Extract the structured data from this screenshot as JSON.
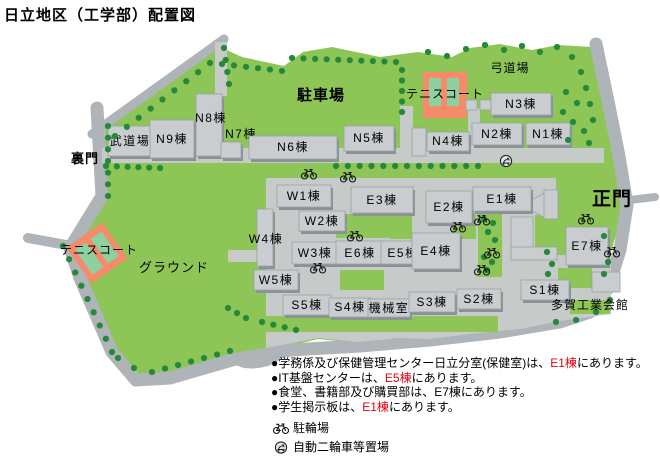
{
  "title": "日立地区（工学部）配置図",
  "map": {
    "area_labels": [
      {
        "id": "parking-lot",
        "label": "駐車場",
        "x": 321,
        "y": 100,
        "size": 15,
        "bold": true
      },
      {
        "id": "kyudo-hall",
        "label": "弓道場",
        "x": 510,
        "y": 72,
        "size": 12,
        "bold": false
      },
      {
        "id": "tennis-court-north",
        "label": "テニスコート",
        "x": 445,
        "y": 98,
        "size": 12,
        "bold": false
      },
      {
        "id": "tennis-court-west",
        "label": "テニスコート",
        "x": 99,
        "y": 254,
        "size": 12,
        "bold": false
      },
      {
        "id": "ground",
        "label": "グラウンド",
        "x": 174,
        "y": 272,
        "size": 13,
        "bold": false
      },
      {
        "id": "back-gate",
        "label": "裏門",
        "x": 85,
        "y": 163,
        "size": 13,
        "bold": true
      },
      {
        "id": "main-gate",
        "label": "正門",
        "x": 612,
        "y": 205,
        "size": 19,
        "bold": true
      },
      {
        "id": "taga-kogyo-hall",
        "label": "多賀工業会館",
        "x": 590,
        "y": 309,
        "size": 12,
        "bold": false
      }
    ],
    "buildings": [
      {
        "id": "budokan",
        "label": "武道場",
        "x": 108,
        "y": 126,
        "w": 44,
        "h": 30,
        "lx": 130,
        "ly": 145
      },
      {
        "id": "n9",
        "label": "N9棟",
        "x": 150,
        "y": 120,
        "w": 44,
        "h": 38,
        "lx": 172,
        "ly": 143
      },
      {
        "id": "n8",
        "label": "N8棟",
        "x": 196,
        "y": 94,
        "w": 26,
        "h": 62,
        "lx": 211,
        "ly": 122
      },
      {
        "id": "n7",
        "label": "N7棟",
        "x": 221,
        "y": 142,
        "w": 20,
        "h": 16,
        "lx": 241,
        "ly": 138
      },
      {
        "id": "n6",
        "label": "N6棟",
        "x": 249,
        "y": 136,
        "w": 88,
        "h": 23,
        "lx": 293,
        "ly": 151
      },
      {
        "id": "n5",
        "label": "N5棟",
        "x": 344,
        "y": 126,
        "w": 50,
        "h": 25,
        "lx": 369,
        "ly": 142
      },
      {
        "id": "n4",
        "label": "N4棟",
        "x": 427,
        "y": 132,
        "w": 42,
        "h": 19,
        "lx": 448,
        "ly": 145
      },
      {
        "id": "n3",
        "label": "N3棟",
        "x": 491,
        "y": 93,
        "w": 60,
        "h": 22,
        "lx": 521,
        "ly": 108
      },
      {
        "id": "n2",
        "label": "N2棟",
        "x": 472,
        "y": 123,
        "w": 50,
        "h": 22,
        "lx": 497,
        "ly": 138
      },
      {
        "id": "n1",
        "label": "N1棟",
        "x": 526,
        "y": 123,
        "w": 44,
        "h": 22,
        "lx": 548,
        "ly": 138
      },
      {
        "id": "w1",
        "label": "W1棟",
        "x": 277,
        "y": 185,
        "w": 54,
        "h": 22,
        "lx": 304,
        "ly": 200
      },
      {
        "id": "w2",
        "label": "W2棟",
        "x": 299,
        "y": 211,
        "w": 46,
        "h": 20,
        "lx": 322,
        "ly": 225
      },
      {
        "id": "w4",
        "label": "W4棟",
        "x": 257,
        "y": 209,
        "w": 16,
        "h": 57,
        "lx": 266,
        "ly": 243
      },
      {
        "id": "w3",
        "label": "W3棟",
        "x": 292,
        "y": 242,
        "w": 46,
        "h": 22,
        "lx": 315,
        "ly": 257
      },
      {
        "id": "w5",
        "label": "W5棟",
        "x": 254,
        "y": 270,
        "w": 44,
        "h": 20,
        "lx": 276,
        "ly": 284
      },
      {
        "id": "e3",
        "label": "E3棟",
        "x": 351,
        "y": 187,
        "w": 62,
        "h": 26,
        "lx": 382,
        "ly": 204
      },
      {
        "id": "e2",
        "label": "E2棟",
        "x": 426,
        "y": 191,
        "w": 46,
        "h": 32,
        "lx": 449,
        "ly": 211
      },
      {
        "id": "e1",
        "label": "E1棟",
        "x": 473,
        "y": 187,
        "w": 58,
        "h": 24,
        "lx": 502,
        "ly": 203
      },
      {
        "id": "e6",
        "label": "E6棟",
        "x": 336,
        "y": 241,
        "w": 48,
        "h": 23,
        "lx": 360,
        "ly": 257
      },
      {
        "id": "e5",
        "label": "E5棟",
        "x": 381,
        "y": 241,
        "w": 44,
        "h": 23,
        "lx": 403,
        "ly": 257
      },
      {
        "id": "e4",
        "label": "E4棟",
        "x": 412,
        "y": 233,
        "w": 48,
        "h": 36,
        "lx": 436,
        "ly": 255
      },
      {
        "id": "e7",
        "label": "E7棟",
        "x": 566,
        "y": 227,
        "w": 42,
        "h": 38,
        "lx": 587,
        "ly": 250
      },
      {
        "id": "s5",
        "label": "S5棟",
        "x": 283,
        "y": 295,
        "w": 48,
        "h": 20,
        "lx": 307,
        "ly": 309
      },
      {
        "id": "s4",
        "label": "S4棟",
        "x": 329,
        "y": 298,
        "w": 42,
        "h": 19,
        "lx": 350,
        "ly": 311
      },
      {
        "id": "kikai",
        "label": "機械室",
        "x": 368,
        "y": 299,
        "w": 42,
        "h": 18,
        "lx": 389,
        "ly": 312
      },
      {
        "id": "s3",
        "label": "S3棟",
        "x": 409,
        "y": 292,
        "w": 46,
        "h": 20,
        "lx": 432,
        "ly": 306
      },
      {
        "id": "s2",
        "label": "S2棟",
        "x": 457,
        "y": 289,
        "w": 44,
        "h": 20,
        "lx": 479,
        "ly": 303
      },
      {
        "id": "s1",
        "label": "S1棟",
        "x": 521,
        "y": 280,
        "w": 48,
        "h": 20,
        "lx": 545,
        "ly": 294
      }
    ],
    "icons": {
      "bicycles": [
        [
          309,
          174
        ],
        [
          348,
          177
        ],
        [
          355,
          236
        ],
        [
          318,
          268
        ],
        [
          458,
          227
        ],
        [
          482,
          220
        ],
        [
          492,
          253
        ],
        [
          482,
          270
        ],
        [
          586,
          219
        ],
        [
          612,
          252
        ]
      ],
      "scooters": [
        [
          506,
          161
        ]
      ]
    }
  },
  "notes": [
    {
      "segments": [
        {
          "t": "●学務係及び保健管理センター日立分室(保健室)は、",
          "c": "black"
        },
        {
          "t": "E1棟",
          "c": "red"
        },
        {
          "t": "にあります。",
          "c": "black"
        }
      ]
    },
    {
      "segments": [
        {
          "t": "●IT基盤センターは、",
          "c": "black"
        },
        {
          "t": "E5棟",
          "c": "red"
        },
        {
          "t": "にあります。",
          "c": "black"
        }
      ]
    },
    {
      "segments": [
        {
          "t": "●食堂、書籍部及び購買部は、E7棟にあります。",
          "c": "black"
        }
      ]
    },
    {
      "segments": [
        {
          "t": "●学生掲示板は、",
          "c": "black"
        },
        {
          "t": "E1棟",
          "c": "red"
        },
        {
          "t": "にあります。",
          "c": "black"
        }
      ]
    }
  ],
  "legend": [
    {
      "icon": "bicycle-icon",
      "label": "駐輪場"
    },
    {
      "icon": "scooter-icon",
      "label": "自動二輪車等置場"
    }
  ],
  "colors": {
    "campus_green": "#8dc556",
    "tree_green": "#27883b",
    "road_gray": "#aeb4b8",
    "paving_gray": "#c6cac8",
    "building_gray": "#c9cdcf",
    "building_shadow": "#8b9297",
    "building_edge": "#9aa1a6",
    "tennis_orange": "#f58b68",
    "tennis_court_green": "#8ed1a0",
    "note_red": "#e60012",
    "text_black": "#000000"
  }
}
